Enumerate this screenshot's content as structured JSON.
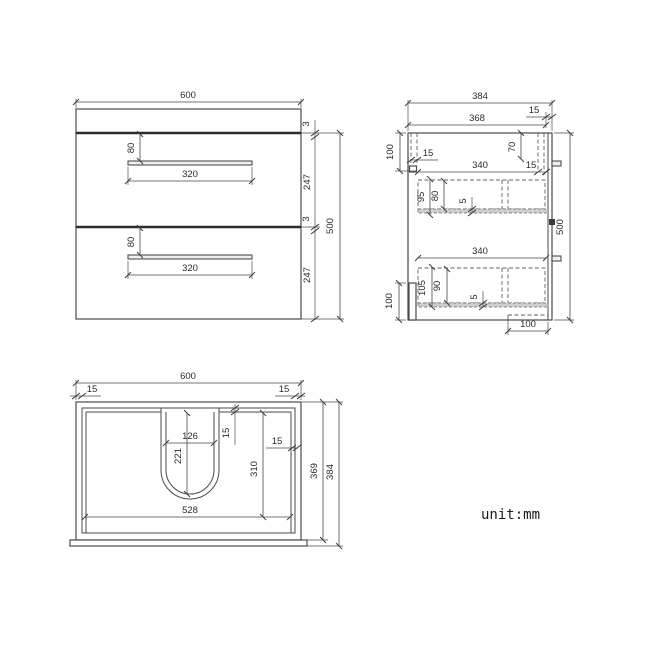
{
  "unit_label": "unit:mm",
  "front": {
    "overall_width": "600",
    "overall_height": "500",
    "top_gap": "3",
    "drawer1_front_height": "247",
    "mid_gap": "3",
    "drawer2_front_height": "247",
    "drawer1_handle_drop": "80",
    "drawer1_handle_width": "320",
    "drawer2_handle_drop": "80",
    "drawer2_handle_width": "320"
  },
  "side": {
    "overall_depth": "384",
    "top_inner_depth": "368",
    "front_edge_offset": "15",
    "top_section_height": "100",
    "back_rail_thickness": "15",
    "front_drop": "70",
    "front_rail_thickness": "15",
    "drawer1_span": "340",
    "drawer1_side_height": "95",
    "drawer1_inner_height": "80",
    "drawer1_bottom_thickness": "5",
    "drawer2_span": "340",
    "drawer2_side_height": "105",
    "drawer2_inner_height": "90",
    "drawer2_bottom_thickness": "5",
    "bottom_back_height": "100",
    "bottom_recess_width": "100",
    "overall_height": "500"
  },
  "plan": {
    "overall_width": "600",
    "left_wall": "15",
    "right_wall": "15",
    "cutout_width": "126",
    "cutout_depth": "221",
    "top_wall": "15",
    "side_wall": "15",
    "basin_depth": "310",
    "inner_width": "528",
    "inner_depth": "369",
    "overall_depth": "384"
  }
}
